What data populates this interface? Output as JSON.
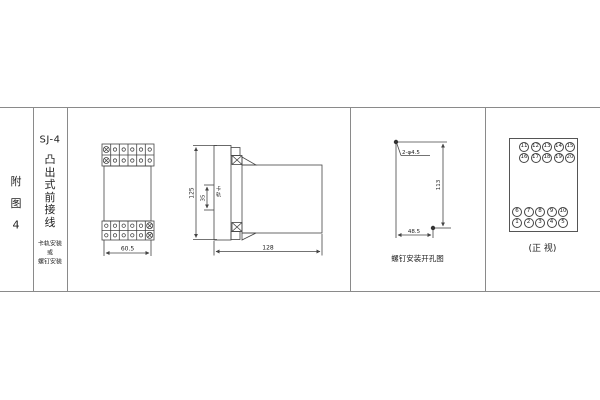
{
  "frame": {
    "line_color": "#8a8a8a"
  },
  "left_column": {
    "chars": [
      "附",
      "图",
      "4"
    ]
  },
  "title_column": {
    "model": "SJ-4",
    "type_chars": [
      "凸",
      "出",
      "式",
      "前",
      "接",
      "线"
    ],
    "mount_lines": [
      "卡轨安装",
      "或",
      "螺钉安装"
    ]
  },
  "front_view": {
    "width_dim": "60.5"
  },
  "side_view": {
    "height_dim": "125",
    "rail_dim": "35",
    "rail_label": "卡轨",
    "depth_dim": "128"
  },
  "drill_view": {
    "holes_label": "2-φ4.5",
    "height_dim": "113",
    "width_dim": "48.5",
    "caption": "螺钉安装开孔图"
  },
  "terminal_view": {
    "caption": "(正 视)",
    "top_rows": [
      [
        "11",
        "12",
        "13",
        "14",
        "15"
      ],
      [
        "16",
        "17",
        "18",
        "19",
        "20"
      ]
    ],
    "bottom_rows": [
      [
        "6",
        "7",
        "8",
        "9",
        "10"
      ],
      [
        "1",
        "2",
        "3",
        "4",
        "5"
      ]
    ]
  }
}
